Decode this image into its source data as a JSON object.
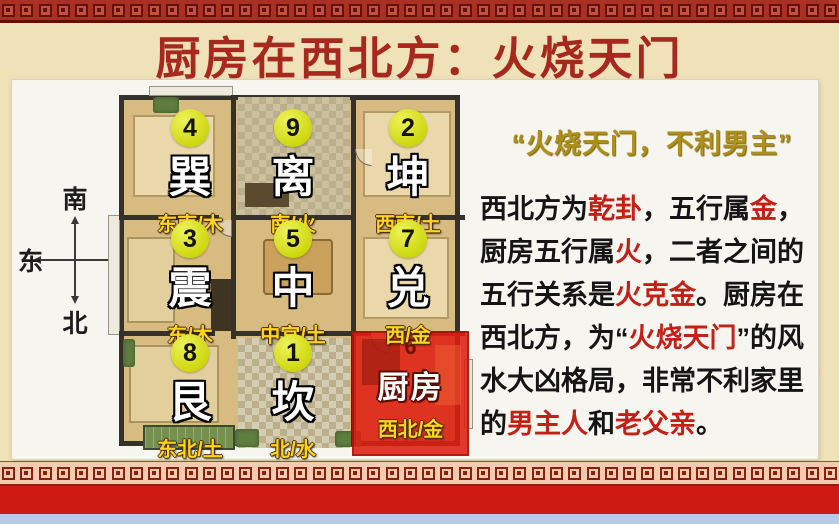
{
  "header": {
    "title": "厨房在西北方：火烧天门"
  },
  "compass": {
    "top": "南",
    "left": "东",
    "right": "西",
    "bottom": "北"
  },
  "floorplan": {
    "sectors": [
      {
        "num": "4",
        "name": "巽",
        "label": "东南/木"
      },
      {
        "num": "9",
        "name": "离",
        "label": "南/火"
      },
      {
        "num": "2",
        "name": "坤",
        "label": "西南/土"
      },
      {
        "num": "3",
        "name": "震",
        "label": "东/木"
      },
      {
        "num": "5",
        "name": "中",
        "label": "中宫/土"
      },
      {
        "num": "7",
        "name": "兑",
        "label": "西/金"
      },
      {
        "num": "8",
        "name": "艮",
        "label": "东北/土"
      },
      {
        "num": "1",
        "name": "坎",
        "label": "北/水"
      },
      {
        "num": "6",
        "name": "厨房",
        "label": "西北/金",
        "highlight": true
      }
    ]
  },
  "analysis": {
    "heading": "“火烧天门，不利男主”",
    "body": [
      {
        "t": "西北方为"
      },
      {
        "t": "乾卦",
        "red": true
      },
      {
        "t": "，五行属"
      },
      {
        "t": "金",
        "red": true
      },
      {
        "t": "，厨房五行属"
      },
      {
        "t": "火",
        "red": true
      },
      {
        "t": "，二者之间的五行关系是"
      },
      {
        "t": "火克金",
        "red": true
      },
      {
        "t": "。厨房在西北方，为“"
      },
      {
        "t": "火烧天门",
        "red": true
      },
      {
        "t": "”的风水大凶格局，非常不利家里的"
      },
      {
        "t": "男主人",
        "red": true
      },
      {
        "t": "和"
      },
      {
        "t": "老父亲",
        "red": true
      },
      {
        "t": "。"
      }
    ]
  },
  "colors": {
    "title_red": "#a6281e",
    "heading_gold": "#ad8f1d",
    "body_highlight_red": "#c32017",
    "sector_circle_yellow": "#d4de20",
    "sector_label_gold": "#ffd41e",
    "kitchen_overlay_red": "#de2012",
    "border_red": "#a93023",
    "background_cream": "#efe1b8"
  }
}
